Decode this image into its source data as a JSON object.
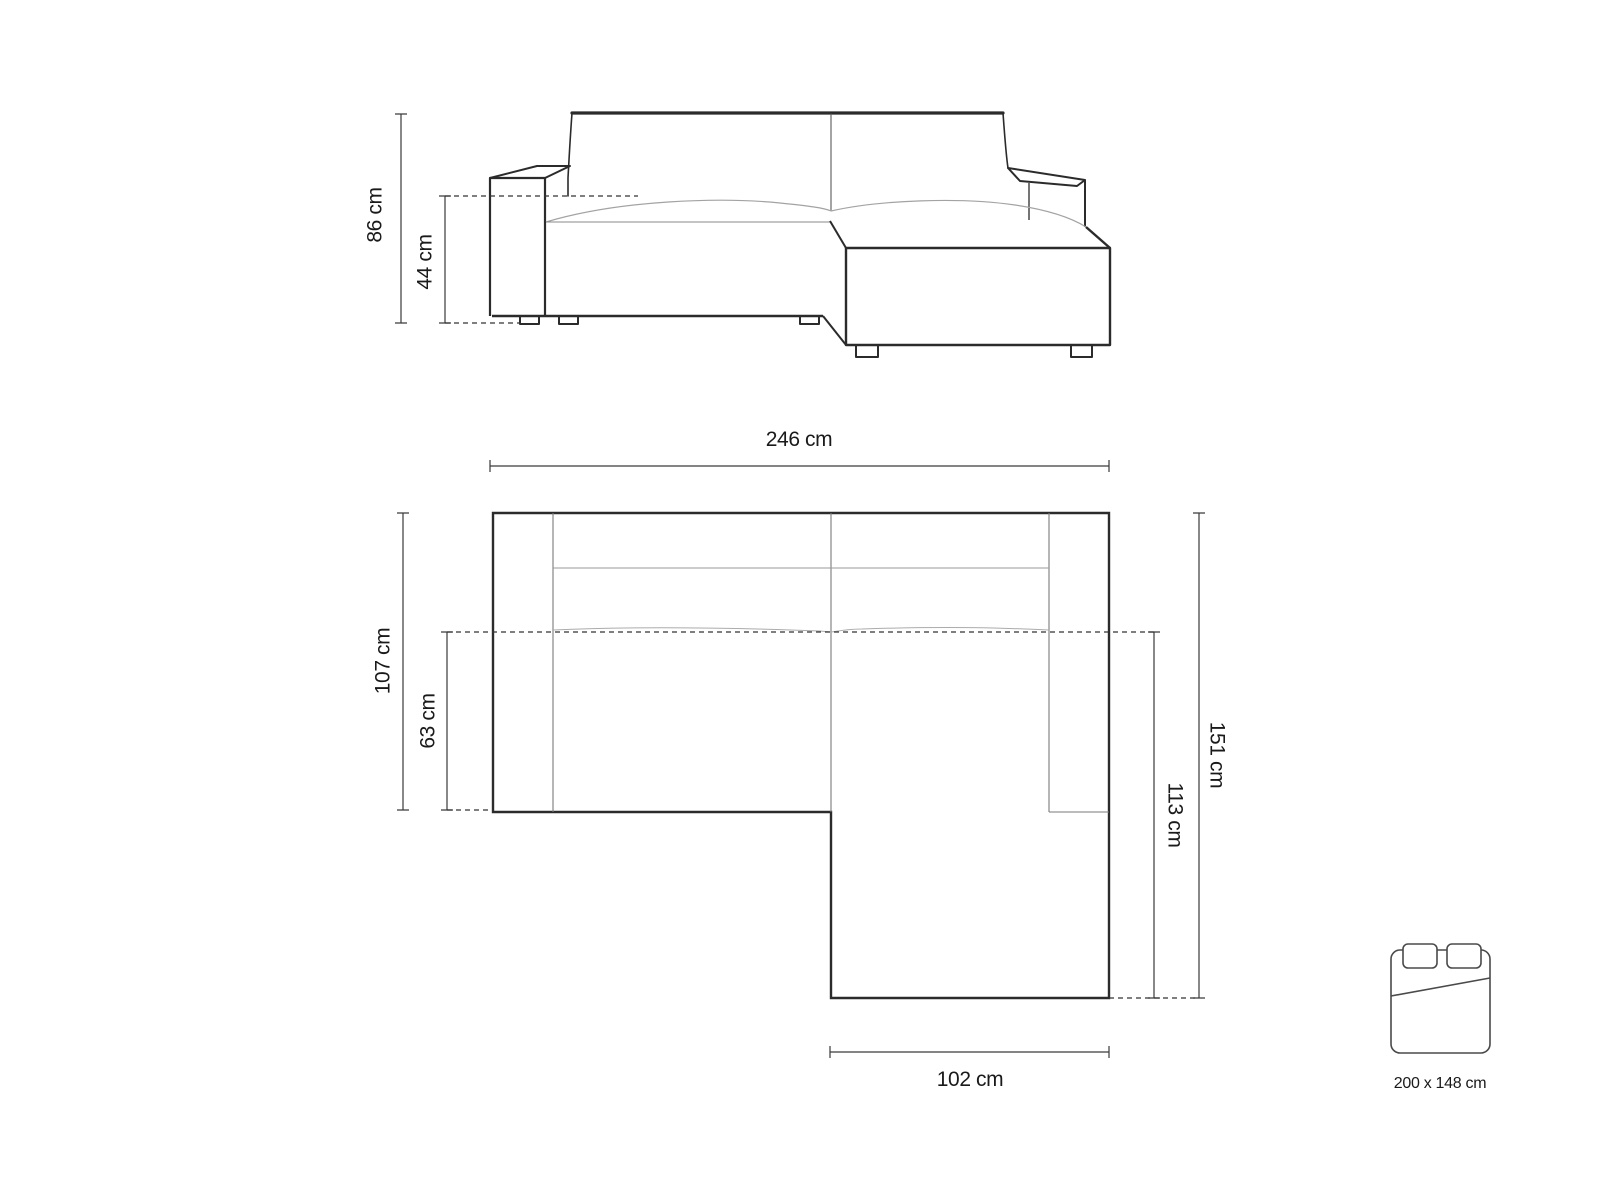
{
  "title": "Corner sofa-bed dimensions diagram",
  "colors": {
    "outline": "#2b2b2b",
    "inner_line": "#7a7a7a",
    "cushion_line": "#a3a3a3",
    "dimension_line": "#3a3a3a",
    "icon_line": "#4a4a4a",
    "text": "#1a1a1a",
    "background": "#ffffff"
  },
  "front_view": {
    "overall_height": "86 cm",
    "seat_height": "44 cm"
  },
  "top_view": {
    "overall_width": "246 cm",
    "main_depth": "107 cm",
    "seat_depth": "63 cm",
    "overall_depth": "151 cm",
    "chaise_depth": "113 cm",
    "chaise_width": "102 cm"
  },
  "bed": {
    "icon": "bed-icon",
    "sleeping_area": "200 x 148 cm"
  }
}
